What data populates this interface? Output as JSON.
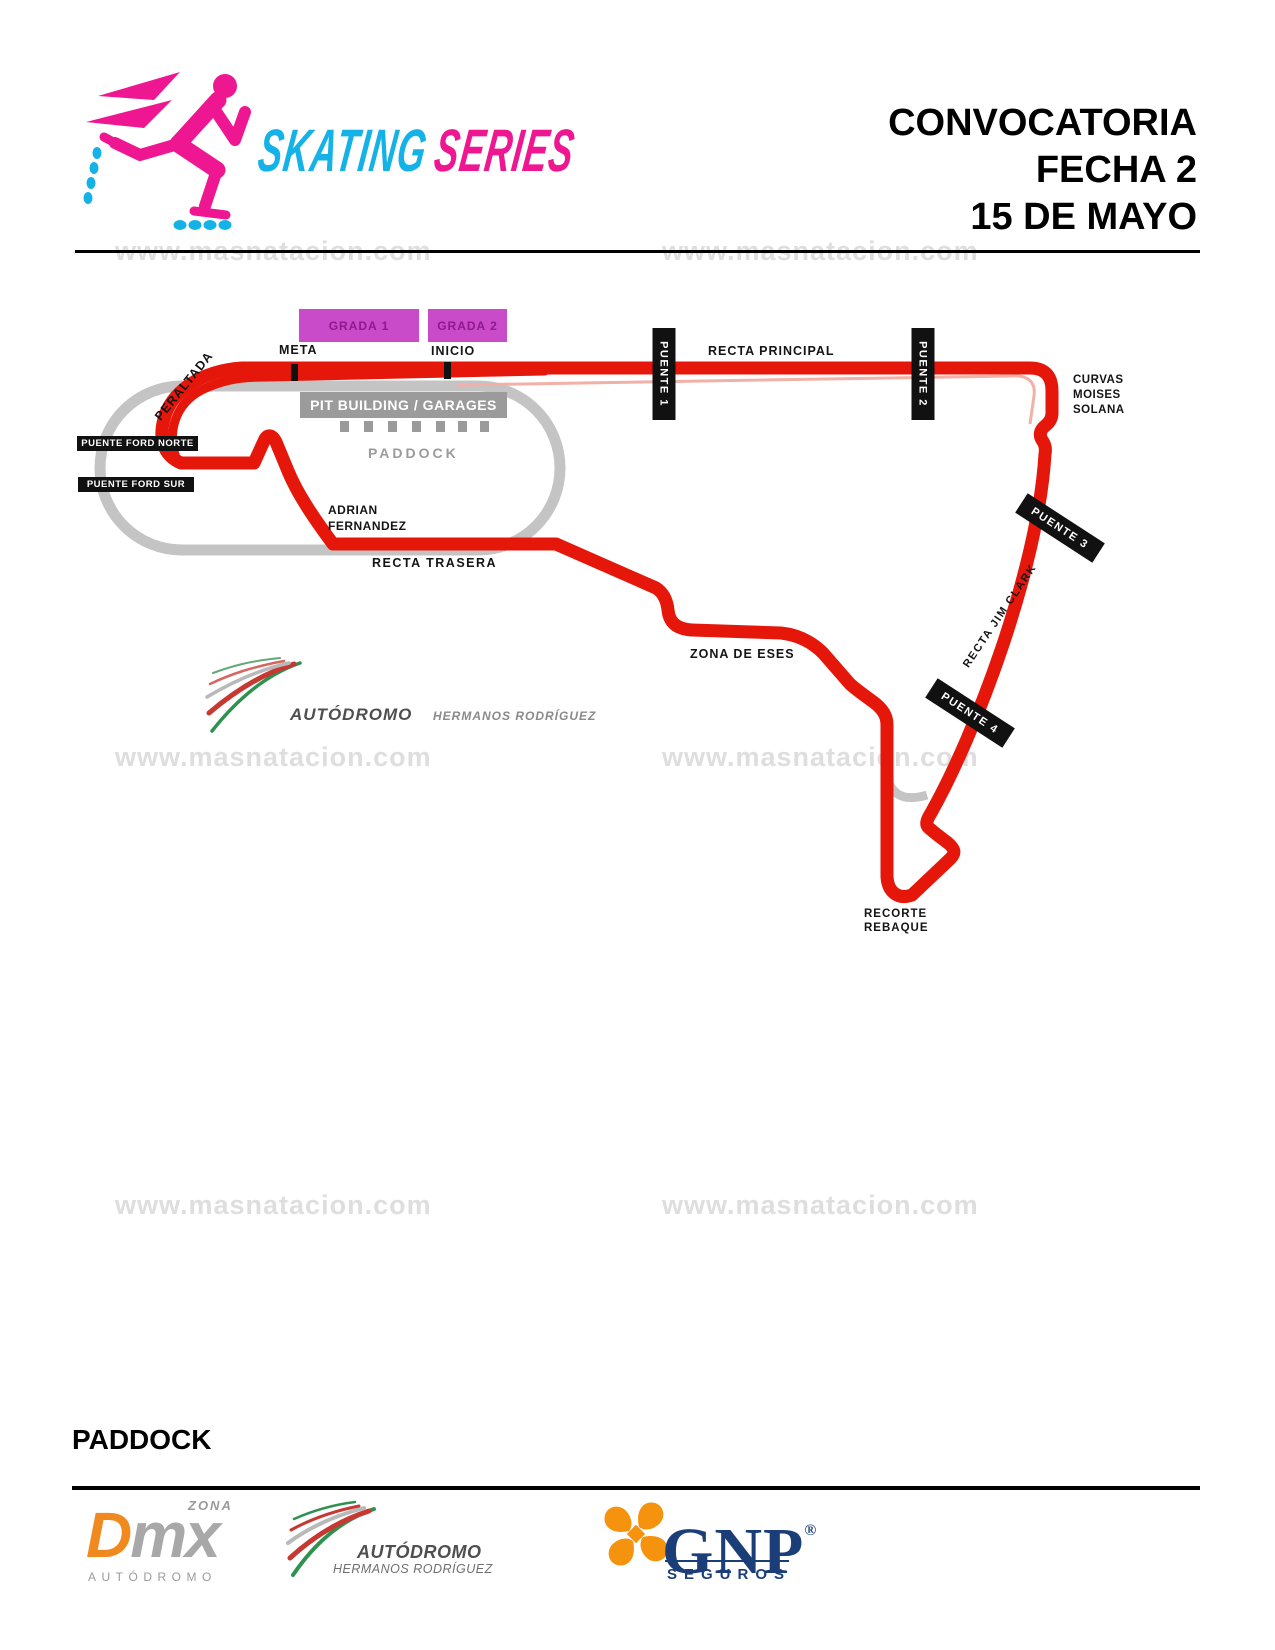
{
  "brand": {
    "skating": "SKATING",
    "series": "SERIES",
    "skating_color": "#14b2e6",
    "series_color": "#ee1691",
    "skater_color": "#ee1691",
    "wheel_color": "#14b2e6"
  },
  "header": {
    "line1": "CONVOCATORIA",
    "line2": "FECHA 2",
    "line3": "15 DE MAYO"
  },
  "watermark": {
    "text": "www.masnatacion.com"
  },
  "map": {
    "track_color": "#e5170b",
    "old_track_color": "#c4c4c4",
    "grada_bg": "#ca4bca",
    "grada1": "GRADA 1",
    "grada2": "GRADA 2",
    "meta": "META",
    "inicio": "INICIO",
    "pit_building": "PIT BUILDING / GARAGES",
    "paddock": "PADDOCK",
    "peraltada": "PERALTADA",
    "puente_ford_norte": "PUENTE FORD NORTE",
    "puente_ford_sur": "PUENTE FORD SUR",
    "adrian_l1": "ADRIAN",
    "adrian_l2": "FERNANDEZ",
    "recta_trasera": "RECTA TRASERA",
    "puente1": "PUENTE 1",
    "puente2": "PUENTE 2",
    "puente3": "PUENTE 3",
    "puente4": "PUENTE 4",
    "recta_principal": "RECTA PRINCIPAL",
    "curvas_l1": "CURVAS",
    "curvas_l2": "MOISES",
    "curvas_l3": "SOLANA",
    "recta_jim_clark": "RECTA JIM CLARK",
    "zona_de_eses": "ZONA DE ESES",
    "recorte_l1": "RECORTE",
    "recorte_l2": "REBAQUE",
    "logo_autodromo": "AUTÓDROMO",
    "logo_hermanos": "HERMANOS RODRÍGUEZ"
  },
  "footer": {
    "heading": "PADDOCK",
    "dmx": {
      "zona": "ZONA",
      "d": "D",
      "mx": "mx",
      "autodromo": "AUTÓDROMO",
      "orange": "#f08a1e",
      "gray": "#a8a8a8"
    },
    "ahr": {
      "autodromo": "AUTÓDROMO",
      "hermanos": "HERMANOS RODRÍGUEZ"
    },
    "gnp": {
      "name": "GNP",
      "reg": "®",
      "seguros": "SEGUROS",
      "blue": "#1c3e78",
      "orange": "#f5930f"
    }
  }
}
